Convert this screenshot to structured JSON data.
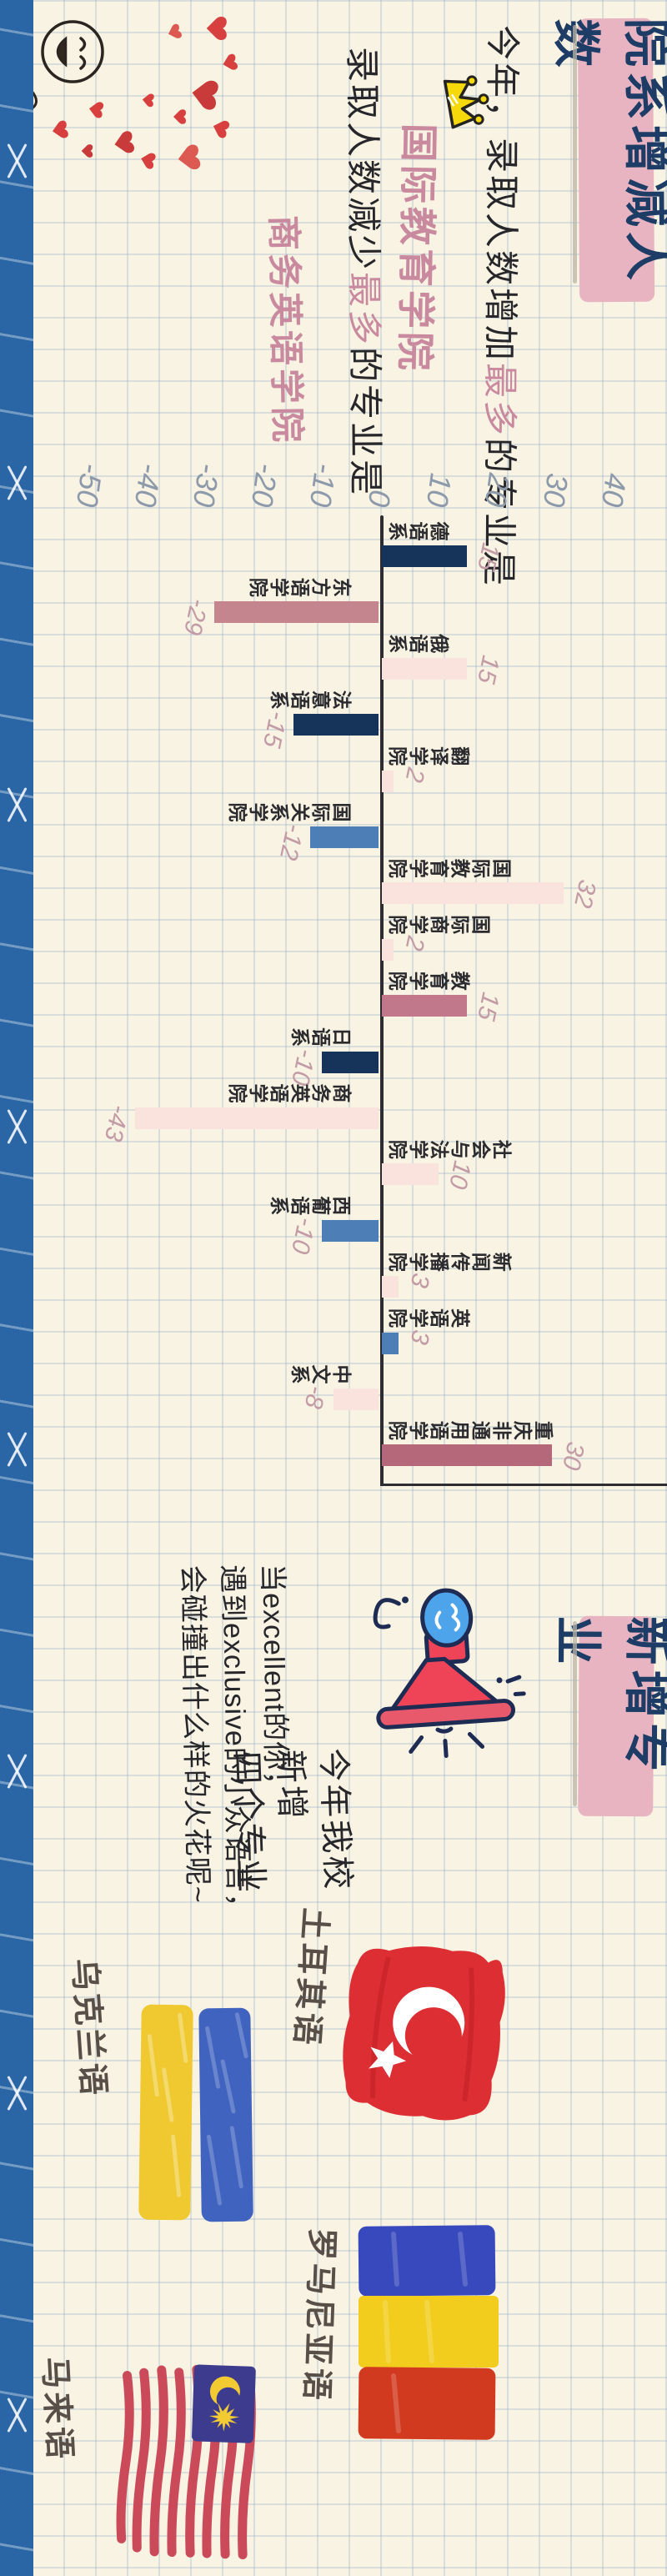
{
  "page": {
    "background": "#f8f3e2",
    "grid_color": "#7da0c3",
    "tape_color": "#2a66a5"
  },
  "section1": {
    "title": "院系增减人数",
    "intro_line1": {
      "pre": "今年，录取人数增加",
      "highlight": "最多",
      "post": "的专业是"
    },
    "answer1": "国际教育学院",
    "intro_line2": {
      "pre": "录取人数减少",
      "highlight": "最多",
      "post": "的专业是"
    },
    "answer2": "商务英语学院",
    "crown_icon": "crown-icon",
    "doodle": "smiley-hearts-doodle"
  },
  "chart_data": {
    "type": "bar",
    "title": "院系增减人数",
    "categories": [
      "德语系",
      "东方语学院",
      "俄语系",
      "法意语系",
      "翻译学院",
      "国际关系学院",
      "国际教育学院",
      "国际商学院",
      "教育学院",
      "日语系",
      "商务英语学院",
      "社会与法学院",
      "西葡语系",
      "新闻传播学院",
      "英语学院",
      "中文系",
      "重庆非通用语学院"
    ],
    "values": [
      15,
      -29,
      15,
      -15,
      2,
      -12,
      32,
      2,
      15,
      -10,
      -43,
      10,
      -10,
      3,
      3,
      -8,
      30
    ],
    "bar_colors": [
      "#16345a",
      "#c5858f",
      "#fae3dd",
      "#16345a",
      "#fae3dd",
      "#4d7fb6",
      "#fae3dd",
      "#fae3dd",
      "#c0788a",
      "#16345a",
      "#fae3dd",
      "#fae3dd",
      "#4d7fb6",
      "#fae3dd",
      "#4d7fb6",
      "#fae3dd",
      "#b5687a"
    ],
    "axis_ticks": [
      40,
      30,
      20,
      10,
      0,
      -10,
      -20,
      -30,
      -40,
      -50
    ],
    "ylim": [
      -50,
      40
    ],
    "xlabel": "",
    "ylabel": "",
    "grid": true,
    "legend": "none",
    "value_label_color": "#c39ba6",
    "tick_color": "#8d9aab"
  },
  "section2": {
    "title": "新增专业",
    "megaphone_icon": "megaphone-icon",
    "announce_lines": [
      "今年我校",
      "新增",
      "四个专业"
    ],
    "tagline_lines": [
      "当excellent的你，",
      "遇到exclusive的小众语言，",
      "会碰撞出什么样的火花呢~"
    ],
    "majors": [
      {
        "name": "土耳其语",
        "flag": "turkey-flag-icon"
      },
      {
        "name": "乌克兰语",
        "flag": "ukraine-flag-icon"
      },
      {
        "name": "罗马尼亚语",
        "flag": "romania-flag-icon"
      },
      {
        "name": "马来语",
        "flag": "malaysia-flag-icon"
      }
    ]
  }
}
